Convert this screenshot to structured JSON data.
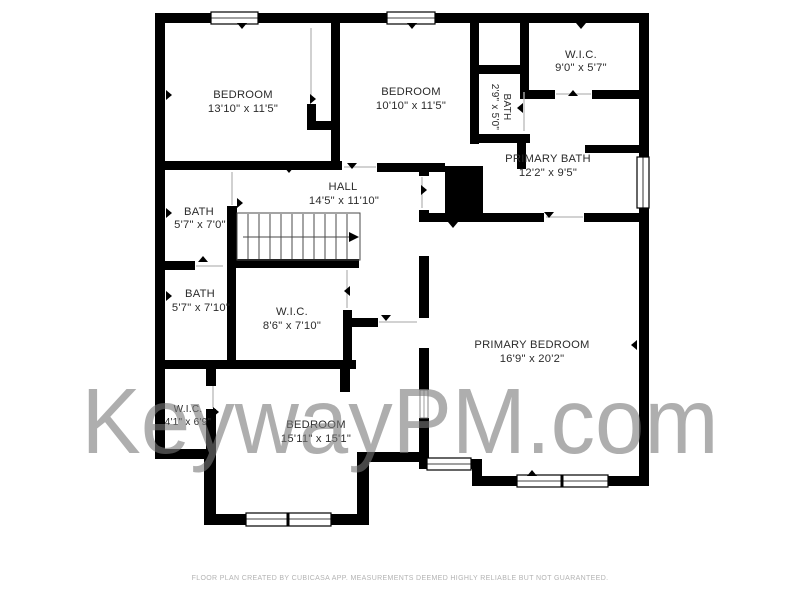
{
  "page": {
    "background": "#ffffff"
  },
  "colors": {
    "wall": "#000000",
    "room_label": "#2b2b2b",
    "watermark": "#787878",
    "disclaimer": "#b3b3b3",
    "door_line": "#b8b8b8",
    "stair_line": "#4a4a4a"
  },
  "watermark": {
    "text": "KeywayPM.com"
  },
  "footer": {
    "disclaimer": "FLOOR PLAN CREATED BY CUBICASA APP. MEASUREMENTS DEEMED HIGHLY RELIABLE BUT NOT GUARANTEED."
  },
  "rooms": [
    {
      "id": "bedroom-top-left",
      "name": "BEDROOM",
      "dims": "13'10\" x 11'5\""
    },
    {
      "id": "bedroom-top-middle",
      "name": "BEDROOM",
      "dims": "10'10\" x 11'5\""
    },
    {
      "id": "wic-top-right",
      "name": "W.I.C.",
      "dims": "9'0\" x 5'7\""
    },
    {
      "id": "water-closet",
      "name": "BATH",
      "dims": "2'9\" x 5'0\""
    },
    {
      "id": "primary-bath",
      "name": "PRIMARY BATH",
      "dims": "12'2\" x 9'5\""
    },
    {
      "id": "hall",
      "name": "HALL",
      "dims": "14'5\" x 11'10\""
    },
    {
      "id": "bath-upper-left",
      "name": "BATH",
      "dims": "5'7\" x 7'0\""
    },
    {
      "id": "bath-lower-left",
      "name": "BATH",
      "dims": "5'7\" x 7'10\""
    },
    {
      "id": "wic-center",
      "name": "W.I.C.",
      "dims": "8'6\" x 7'10\""
    },
    {
      "id": "primary-bedroom",
      "name": "PRIMARY BEDROOM",
      "dims": "16'9\" x 20'2\""
    },
    {
      "id": "wic-bottom-left",
      "name": "W.I.C.",
      "dims": "4'1\" x 6'9\""
    },
    {
      "id": "bedroom-bottom",
      "name": "BEDROOM",
      "dims": "15'11\" x 15'1\""
    }
  ]
}
